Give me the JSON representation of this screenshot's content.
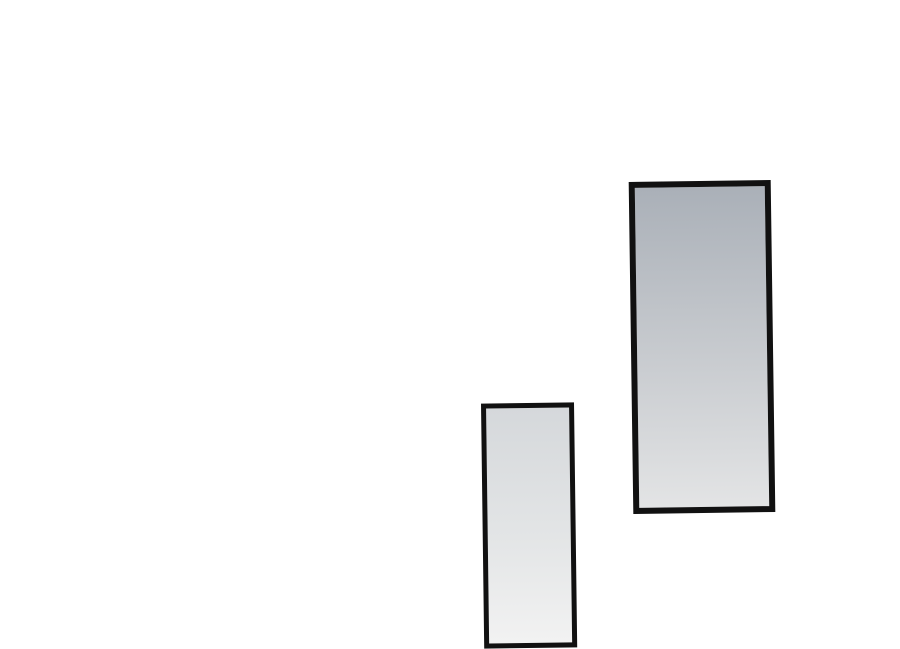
{
  "page": {
    "description": "Blank white comic page area containing two empty tilted panels",
    "background_color": "#ffffff"
  },
  "panels": [
    {
      "name": "large-panel",
      "border_color": "#111111",
      "gradient_angle": 180,
      "gradient_top": "#aab0b8",
      "gradient_mid": "#c9ccd0",
      "gradient_bottom": "#e3e4e5"
    },
    {
      "name": "small-panel",
      "border_color": "#111111",
      "gradient_angle": 180,
      "gradient_top": "#d5d8db",
      "gradient_mid": "#e3e5e6",
      "gradient_bottom": "#f2f2f2"
    }
  ]
}
